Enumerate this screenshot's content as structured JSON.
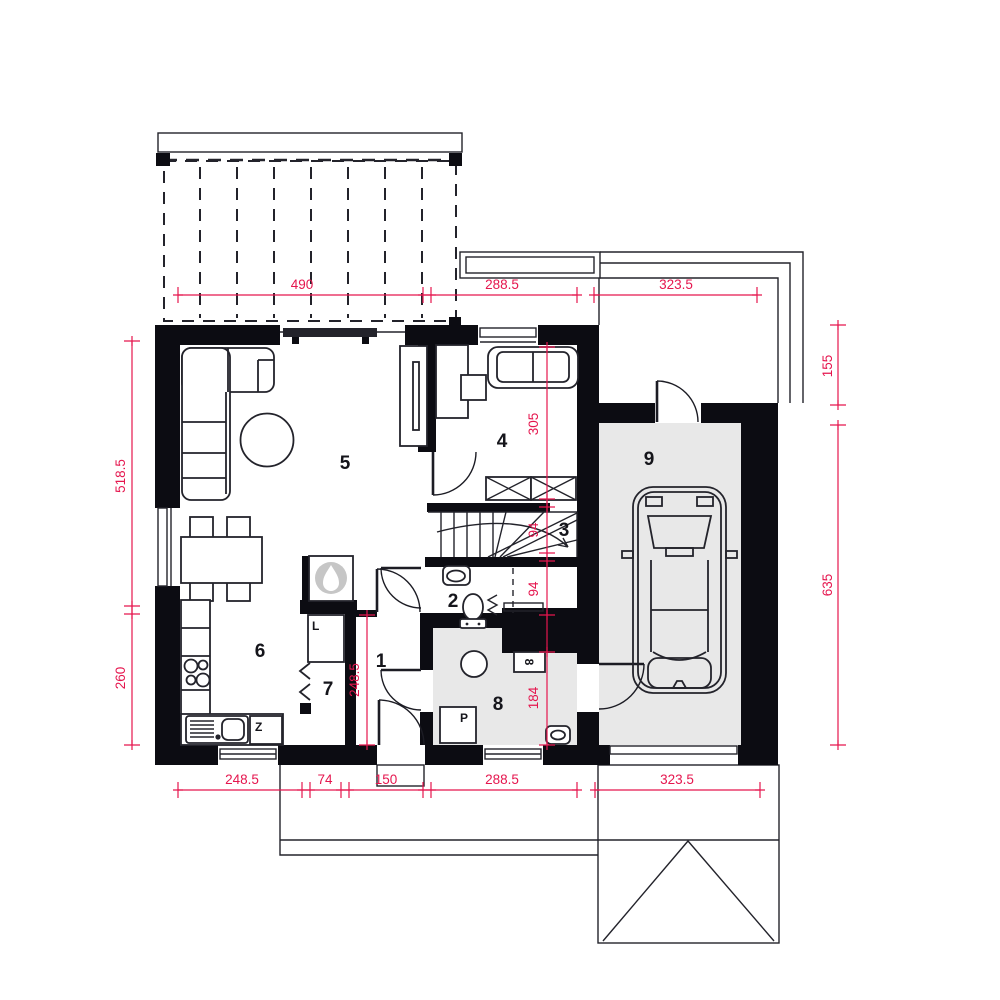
{
  "plan": {
    "type": "house-ground-floor-plan",
    "rooms": [
      "1",
      "2",
      "3",
      "4",
      "5",
      "6",
      "7",
      "8",
      "9"
    ],
    "appliances": {
      "fridge": "L",
      "dishwasher": "Z",
      "washing_machine": "P",
      "boiler_box": "8"
    },
    "dimensions": {
      "top": [
        "490",
        "288.5",
        "323.5"
      ],
      "bottom": [
        "248.5",
        "74",
        "150",
        "288.5",
        "323.5"
      ],
      "left": [
        "518.5",
        "260"
      ],
      "right": [
        "155",
        "635"
      ],
      "inner_column_a": [
        "305",
        "94",
        "94",
        "184"
      ],
      "inner_column_b": [
        "248.5"
      ]
    },
    "colors": {
      "dim": "#e5164e",
      "wall": "#0c0c12",
      "floor": "#e8e8e8",
      "flame": "#c6c6c6"
    }
  }
}
